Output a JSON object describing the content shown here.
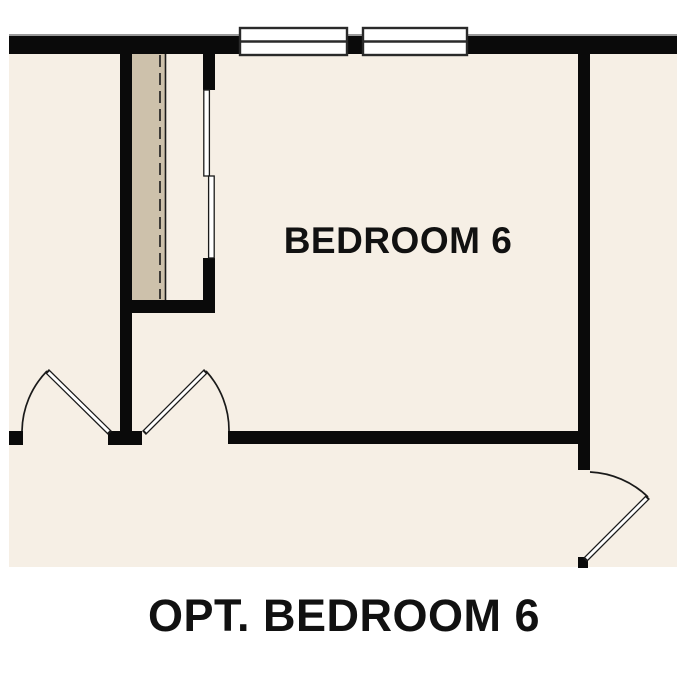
{
  "labels": {
    "room": "BEDROOM 6",
    "caption": "OPT. BEDROOM 6"
  },
  "features": {
    "windows": [
      "window",
      "window"
    ],
    "doors": [
      "hinged-door-left",
      "hinged-door-right",
      "hinged-door-entry"
    ],
    "closet": [
      "shelf",
      "hang-rod",
      "bypass-sliding-doors"
    ]
  },
  "colors": {
    "background": "#ffffff",
    "floor": "#f6efe5",
    "shelf": "#cdc1ab",
    "wall": "#0a0a0a",
    "outline": "#1a1a1a",
    "text": "#111111"
  }
}
